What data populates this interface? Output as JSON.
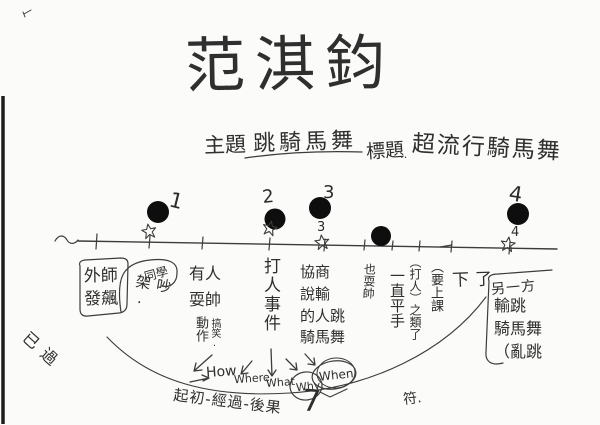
{
  "header": {
    "student_name": "范淇鈞",
    "topic_label": "主題",
    "topic_value": "跳騎馬舞",
    "title_label": "標題",
    "title_dots": "‥",
    "title_value": "超流行騎馬舞"
  },
  "margin": {
    "check_note": "已過",
    "grade_mark": "符."
  },
  "timeline": {
    "points": [
      {
        "n": "1",
        "sub": ""
      },
      {
        "n": "2",
        "sub": ""
      },
      {
        "n": "3",
        "sub": "3"
      },
      {
        "n": "",
        "sub": ""
      },
      {
        "n": "4",
        "sub": "4"
      }
    ]
  },
  "notes": {
    "n1": "外師\n發飆",
    "n2_side": "同學",
    "n2": "吵架.",
    "n3": "有人\n耍帥",
    "n3_sub_a": "動作",
    "n3_sub_b": "搞笑.",
    "n4": "打人事件",
    "n5": "協商\n說輸\n的人跳\n騎馬舞",
    "n5_side": "也耍帥",
    "n6": "一直平手",
    "n6_side": "（打人）之類了",
    "n7_side": "（要上課",
    "n7": "下了",
    "n8_head": "另一方",
    "n8": "輸跳\n騎馬舞\n（亂跳"
  },
  "analysis": {
    "arrow_words": [
      "How",
      "Where",
      "What",
      "Why",
      "When"
    ],
    "structure": "起初-經過-後果",
    "mark_seven": "7"
  }
}
